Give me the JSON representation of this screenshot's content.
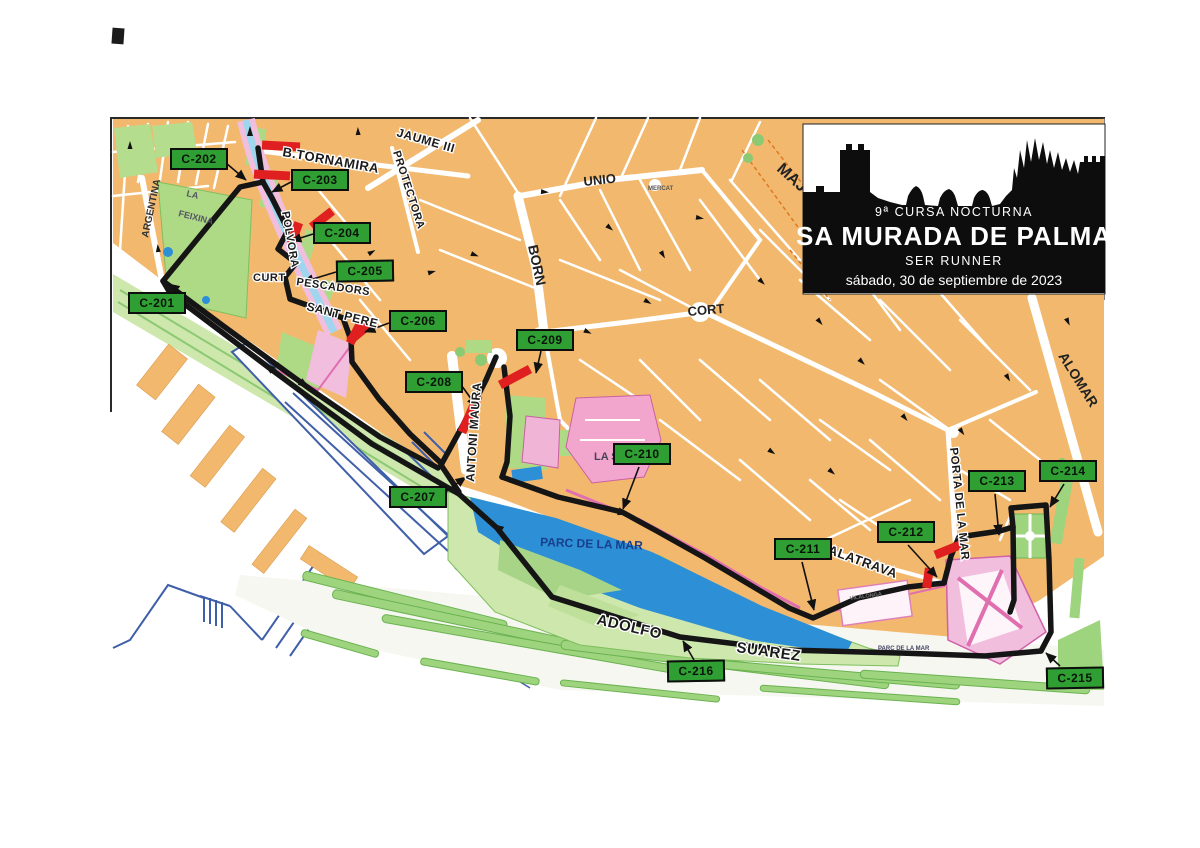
{
  "title_box": {
    "line1": "9ª CURSA NOCTURNA",
    "line2": "SA MURADA DE PALMA",
    "line3": "SER RUNNER",
    "line4": "sábado, 30 de septiembre de 2023"
  },
  "checkpoints": [
    {
      "label": "C-201"
    },
    {
      "label": "C-202"
    },
    {
      "label": "C-203"
    },
    {
      "label": "C-204"
    },
    {
      "label": "C-205"
    },
    {
      "label": "C-206"
    },
    {
      "label": "C-207"
    },
    {
      "label": "C-208"
    },
    {
      "label": "C-209"
    },
    {
      "label": "C-210"
    },
    {
      "label": "C-211"
    },
    {
      "label": "C-212"
    },
    {
      "label": "C-213"
    },
    {
      "label": "C-214"
    },
    {
      "label": "C-215"
    },
    {
      "label": "C-216"
    }
  ],
  "streets": [
    {
      "name": "B.TORNAMIRA"
    },
    {
      "name": "JAUME III"
    },
    {
      "name": "PROTECTORA"
    },
    {
      "name": "UNIO"
    },
    {
      "name": "MERCAT"
    },
    {
      "name": "BORN"
    },
    {
      "name": "CORT"
    },
    {
      "name": "MAJ"
    },
    {
      "name": "ALOMAR"
    },
    {
      "name": "ARGENTINA"
    },
    {
      "name": "POLVORA"
    },
    {
      "name": "CURT"
    },
    {
      "name": "PESCADORS"
    },
    {
      "name": "SANT PERE"
    },
    {
      "name": "ANTONI MAURA"
    },
    {
      "name": "PORTA DE LA MAR"
    },
    {
      "name": "CALATRAVA"
    },
    {
      "name": "ADOLFO"
    },
    {
      "name": "SUAREZ"
    }
  ],
  "areas": [
    {
      "name": "LA"
    },
    {
      "name": "FEIXINA"
    },
    {
      "name": "LA SEU"
    },
    {
      "name": "PARC DE LA MAR"
    },
    {
      "name": "PARC DE LA MAR"
    },
    {
      "name": "VILALONGA"
    }
  ],
  "colors": {
    "checkpoint_green": "#2f9e33",
    "route_black": "#151515",
    "barrier_red": "#e02020",
    "block_orange": "#f2b96e",
    "park_green": "#b5dd8e",
    "lake_blue": "#2d8fd5",
    "landmark_pink": "#f3a6cd"
  }
}
